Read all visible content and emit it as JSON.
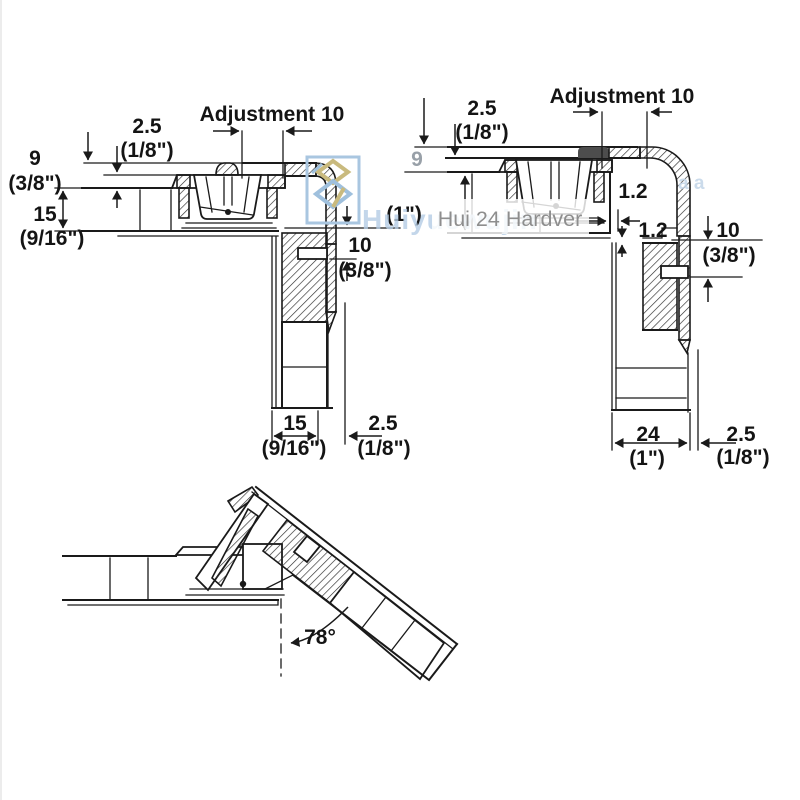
{
  "page": {
    "background": "#ffffff",
    "line_color": "#1a1a1a"
  },
  "watermark": {
    "logo_icon": "interlocked-diamonds-logo",
    "brand_text": "Huiyuewujin",
    "overlay_text": "Hui 24 Hardver",
    "fragment_text": "a a",
    "blue": "#b5cde5",
    "gold": "#c9ba7e",
    "gray": "#8e8e8e"
  },
  "left_diagram": {
    "adjustment_label": "Adjustment 10",
    "dim_top_gap_mm": "2.5",
    "dim_top_gap_in": "(1/8\")",
    "dim_overlay_mm": "9",
    "dim_overlay_in": "(3/8\")",
    "dim_panel_mm": "15",
    "dim_panel_in": "(9/16\")",
    "dim_drill_mm": "10",
    "dim_drill_in": "(3/8\")",
    "dim_door_mm": "15",
    "dim_door_in": "(9/16\")",
    "dim_reveal_mm": "2.5",
    "dim_reveal_in": "(1/8\")"
  },
  "right_diagram": {
    "adjustment_label": "Adjustment 10",
    "dim_top_gap_mm": "2.5",
    "dim_top_gap_in": "(1/8\")",
    "dim_overlay_mm": "9",
    "dim_panel_in": "(1\")",
    "dim_clearance_a": "1.2",
    "dim_clearance_b": "1.2",
    "dim_drill_mm": "10",
    "dim_drill_in": "(3/8\")",
    "dim_door_mm": "24",
    "dim_door_in": "(1\")",
    "dim_reveal_mm": "2.5",
    "dim_reveal_in": "(1/8\")"
  },
  "bottom_diagram": {
    "opening_angle_label": "78°"
  }
}
